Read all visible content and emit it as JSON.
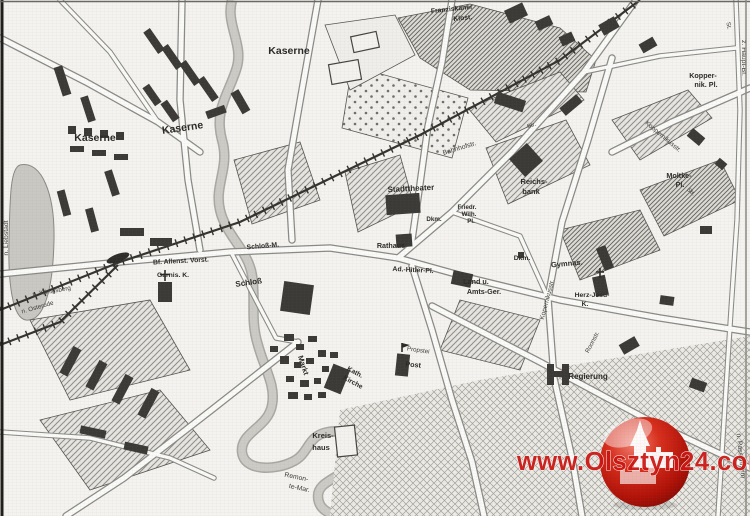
{
  "map_type": "scanned historical city map (Allenstein / Olsztyn)",
  "colors": {
    "paper": "#f4f3f0",
    "ink": "#2b2a26",
    "water": "#c7c6c0",
    "hatch": "#8e8d88",
    "watermark_red": "#cc1511"
  },
  "icons": {
    "logo": "olsztyn24-castle-sphere",
    "station": "railway-station-lens",
    "church": "church-cross",
    "post_flag": "post-flag"
  },
  "watermark": {
    "text": "www.Olsztyn24.com"
  },
  "labels": [
    {
      "id": "kaserne-1",
      "text": "Kaserne"
    },
    {
      "id": "kaserne-2",
      "text": "Kaserne"
    },
    {
      "id": "kaserne-3",
      "text": "Kaserne"
    },
    {
      "id": "franziskaner-1",
      "text": "Franziskaner"
    },
    {
      "id": "franziskaner-2",
      "text": "Klost."
    },
    {
      "id": "bahnhofstr",
      "text": "Bahnhofstr."
    },
    {
      "id": "stadttheater",
      "text": "Stadttheater"
    },
    {
      "id": "reichsbank-1",
      "text": "Reichs-"
    },
    {
      "id": "reichsbank-2",
      "text": "bank"
    },
    {
      "id": "friedr",
      "text": "Friedr."
    },
    {
      "id": "wilh",
      "text": "Wilh."
    },
    {
      "id": "pl-1",
      "text": "Pl."
    },
    {
      "id": "dkm-1",
      "text": "Dkm."
    },
    {
      "id": "dkm-2",
      "text": "Dkm."
    },
    {
      "id": "rathaus",
      "text": "Rathaus"
    },
    {
      "id": "adolf-hitler-pl",
      "text": "Ad.-Hitler-Pl."
    },
    {
      "id": "land-u",
      "text": "Land u."
    },
    {
      "id": "amts-ger",
      "text": "Amts-Ger."
    },
    {
      "id": "gymnasium",
      "text": "Gymnas."
    },
    {
      "id": "herz-jesu-1",
      "text": "Herz-Jesu-"
    },
    {
      "id": "herz-jesu-2",
      "text": "K."
    },
    {
      "id": "koppernik-pl-1",
      "text": "Kopper-"
    },
    {
      "id": "koppernik-pl-2",
      "text": "nik. Pl."
    },
    {
      "id": "moltke-1",
      "text": "Moltke-"
    },
    {
      "id": "moltke-2",
      "text": "Pl."
    },
    {
      "id": "kopernikusstr-1",
      "text": "Koppernikusstr."
    },
    {
      "id": "kopernikusstr-2",
      "text": "Kopernikusstr."
    },
    {
      "id": "z-haupt-bf",
      "text": "z. Haupt-Bf."
    },
    {
      "id": "bf-allenst-vorst",
      "text": "Bf. Allenst. Vorst."
    },
    {
      "id": "garnis-k",
      "text": "Garnis. K."
    },
    {
      "id": "schloss-m",
      "text": "Schloß-M."
    },
    {
      "id": "schloss",
      "text": "Schloß"
    },
    {
      "id": "markt",
      "text": "Markt"
    },
    {
      "id": "kath",
      "text": "Kath."
    },
    {
      "id": "kirche",
      "text": "Kirche"
    },
    {
      "id": "propstei",
      "text": "Propstei"
    },
    {
      "id": "post",
      "text": "Post"
    },
    {
      "id": "regierung",
      "text": "Regierung"
    },
    {
      "id": "kreishaus-1",
      "text": "Kreis-"
    },
    {
      "id": "kreishaus-2",
      "text": "haus"
    },
    {
      "id": "remonte-1",
      "text": "Remon-"
    },
    {
      "id": "remonte-2",
      "text": "te-Mar."
    },
    {
      "id": "n-liebstadt",
      "text": "n. Liebstadt"
    },
    {
      "id": "n-koenigsberg",
      "text": "n. Königsberg"
    },
    {
      "id": "n-osterode",
      "text": "n. Osterode"
    },
    {
      "id": "n-passenheim",
      "text": "n. Passenheim"
    },
    {
      "id": "roonstr",
      "text": "Roonstr."
    },
    {
      "id": "str-1",
      "text": "Str."
    },
    {
      "id": "str-2",
      "text": "Str."
    },
    {
      "id": "str-3",
      "text": "St."
    }
  ]
}
